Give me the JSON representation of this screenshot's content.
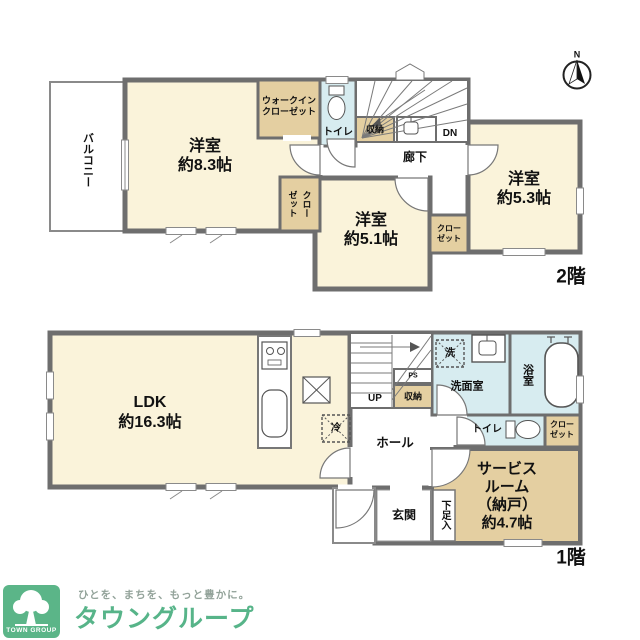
{
  "floor2": {
    "floor_label": "2階",
    "compass_n": "N",
    "balcony": "バルコニー",
    "bedroom_a": {
      "name": "洋室",
      "size": "約8.3帖"
    },
    "wic": {
      "line1": "ウォークイン",
      "line2": "クローゼット"
    },
    "toilet": "トイレ",
    "storage": "収納",
    "stairs_dn": "DN",
    "hallway": "廊下",
    "closet_left": {
      "col1": "クロー",
      "col2": "ゼット"
    },
    "bedroom_b": {
      "name": "洋室",
      "size": "約5.1帖"
    },
    "closet_mid": {
      "line1": "クロー",
      "line2": "ゼット"
    },
    "bedroom_c": {
      "name": "洋室",
      "size": "約5.3帖"
    }
  },
  "floor1": {
    "floor_label": "1階",
    "ldk": {
      "name": "LDK",
      "size": "約16.3帖"
    },
    "fridge": "冷",
    "stairs_up": "UP",
    "ps": "PS",
    "storage": "収納",
    "laundry": "洗",
    "washroom": "洗面室",
    "bathroom": "浴室",
    "toilet": "トイレ",
    "closet": {
      "line1": "クロー",
      "line2": "ゼット"
    },
    "service_room": {
      "line1": "サービス",
      "line2": "ルーム",
      "line3": "（納戸）",
      "line4": "約4.7帖"
    },
    "hall": "ホール",
    "entrance": "玄関",
    "shoe_box": "下足入"
  },
  "logo": {
    "tagline": "ひとを、まちを、もっと豊かに。",
    "brand": "タウングループ",
    "mark": "TOWN GROUP"
  },
  "colors": {
    "wall": "#6e6e6e",
    "room_cream": "#faf3da",
    "closet_tan": "#e4cfa1",
    "wet_blue": "#d7ecf0",
    "brand_green": "#5bb588"
  }
}
